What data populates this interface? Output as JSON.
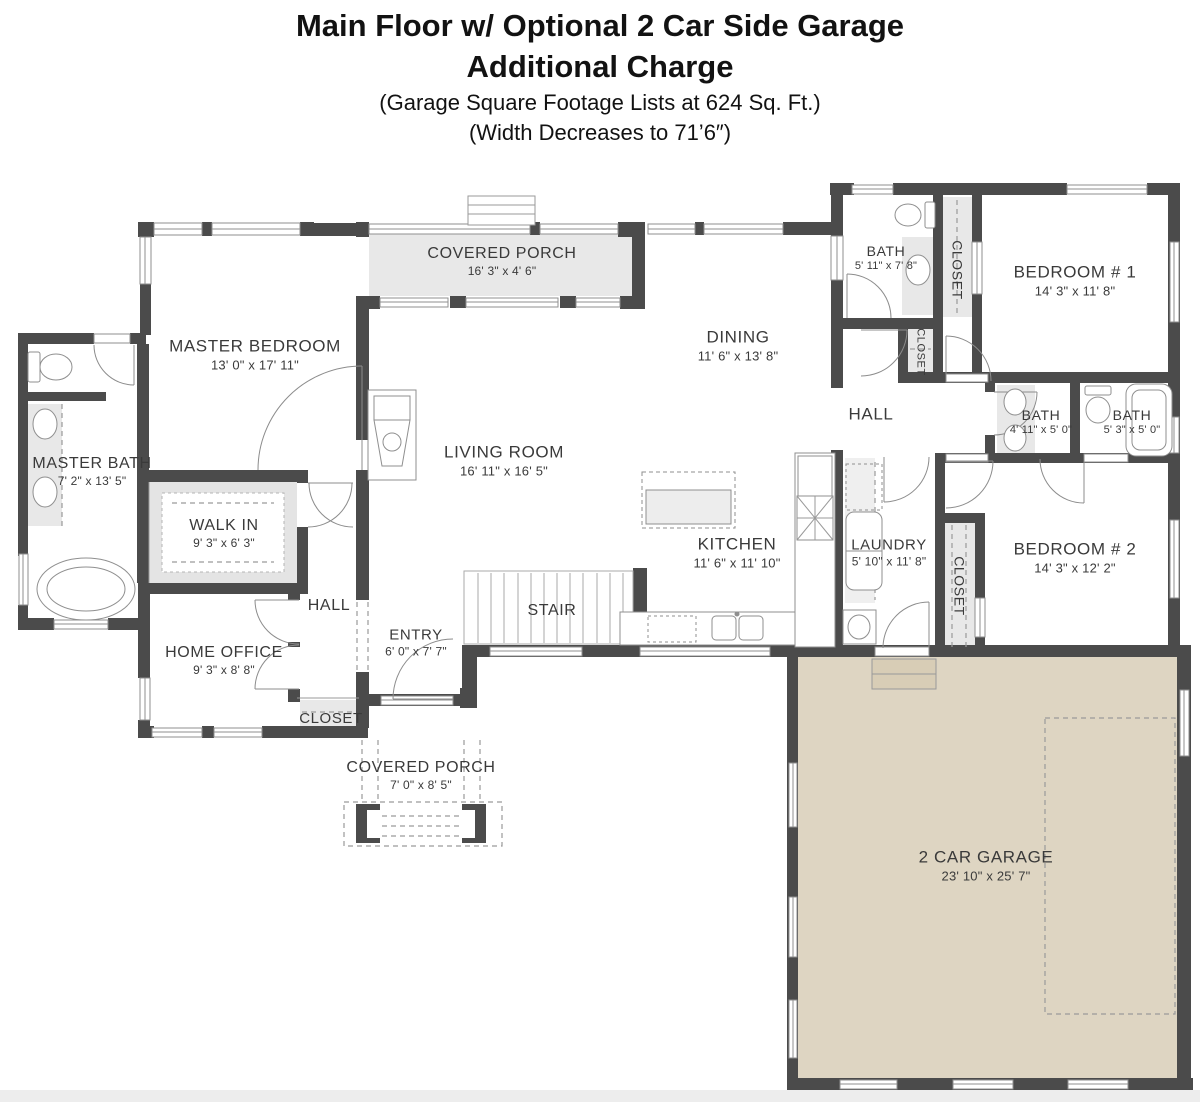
{
  "title": {
    "line1": "Main Floor w/ Optional 2 Car Side Garage",
    "line2": "Additional Charge",
    "line3": "(Garage Square Footage Lists at 624 Sq. Ft.)",
    "line4": "(Width Decreases to 71’6″)"
  },
  "colors": {
    "wall": "#4b4b4b",
    "garage_fill": "#ded5c2",
    "gray_fill": "#e8e8e8",
    "thin_line": "#8f8f8f"
  },
  "rooms": {
    "covered_porch_top": {
      "name": "COVERED PORCH",
      "dims": "16' 3\" x 4' 6\""
    },
    "master_bedroom": {
      "name": "MASTER BEDROOM",
      "dims": "13' 0\" x 17' 11\""
    },
    "dining": {
      "name": "DINING",
      "dims": "11' 6\" x 13' 8\""
    },
    "bath_top": {
      "name": "BATH",
      "dims": "5' 11\" x 7' 8\""
    },
    "closet_bath_top": {
      "name": "CLOSET"
    },
    "bedroom_1": {
      "name": "BEDROOM # 1",
      "dims": "14' 3\" x 11' 8\""
    },
    "closet_hall": {
      "name": "CLOSET"
    },
    "hall_right": {
      "name": "HALL"
    },
    "bath_middle": {
      "name": "BATH",
      "dims": "4' 11\" x 5' 0\""
    },
    "bath_right": {
      "name": "BATH",
      "dims": "5' 3\" x 5' 0\""
    },
    "master_bath": {
      "name": "MASTER BATH",
      "dims": "7' 2\" x 13' 5\""
    },
    "walk_in": {
      "name": "WALK IN",
      "dims": "9' 3\" x 6' 3\""
    },
    "living_room": {
      "name": "LIVING ROOM",
      "dims": "16' 11\" x 16' 5\""
    },
    "kitchen": {
      "name": "KITCHEN",
      "dims": "11' 6\" x 11' 10\""
    },
    "laundry": {
      "name": "LAUNDRY",
      "dims": "5' 10\" x 11' 8\""
    },
    "closet_laundry": {
      "name": "CLOSET"
    },
    "bedroom_2": {
      "name": "BEDROOM # 2",
      "dims": "14' 3\" x 12' 2\""
    },
    "hall_left": {
      "name": "HALL"
    },
    "home_office": {
      "name": "HOME OFFICE",
      "dims": "9' 3\" x 8' 8\""
    },
    "entry": {
      "name": "ENTRY",
      "dims": "6' 0\" x 7' 7\""
    },
    "stair": {
      "name": "STAIR"
    },
    "closet_bottom": {
      "name": "CLOSET"
    },
    "covered_porch_bottom": {
      "name": "COVERED PORCH",
      "dims": "7' 0\" x 8' 5\""
    },
    "garage": {
      "name": "2 CAR GARAGE",
      "dims": "23' 10\" x 25' 7\""
    }
  }
}
